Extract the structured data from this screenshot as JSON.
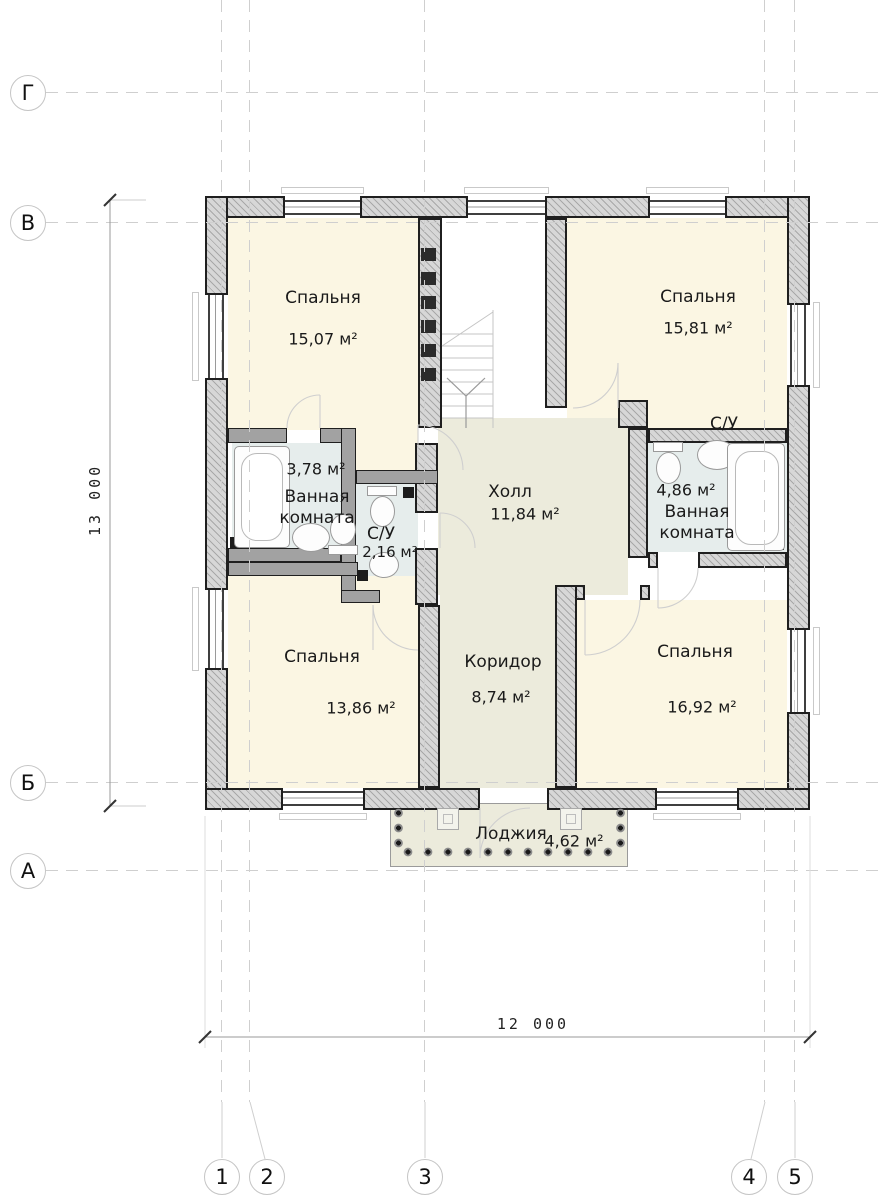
{
  "drawing_type": "architectural floor plan (second storey)",
  "axes": {
    "horizontal": [
      {
        "label": "Г"
      },
      {
        "label": "В"
      },
      {
        "label": "Б"
      },
      {
        "label": "А"
      }
    ],
    "vertical": [
      {
        "label": "1"
      },
      {
        "label": "2"
      },
      {
        "label": "3"
      },
      {
        "label": "4"
      },
      {
        "label": "5"
      }
    ]
  },
  "dims": {
    "height_label": "13 000",
    "width_label": "12 000"
  },
  "rooms": [
    {
      "name": "Спальня",
      "area": "15,07 м²"
    },
    {
      "name": "Спальня",
      "area": "15,81 м²"
    },
    {
      "name": "Ванная комната",
      "area": "3,78 м²"
    },
    {
      "name": "С/У",
      "area": "2,16 м²"
    },
    {
      "name": "Холл",
      "area": "11,84 м²"
    },
    {
      "name": "С/У"
    },
    {
      "name": "Ванная комната",
      "area": "4,86 м²"
    },
    {
      "name": "Спальня",
      "area": "13,86 м²"
    },
    {
      "name": "Коридор",
      "area": "8,74 м²"
    },
    {
      "name": "Спальня",
      "area": "16,92 м²"
    },
    {
      "name": "Лоджия",
      "area": "4,62 м²"
    }
  ],
  "palette": {
    "room_fill": "#fbf6e3",
    "wet_room_fill": "#e6edec",
    "hall_fill": "#ecebdc",
    "wall_fill": "#d7d7d7",
    "wall_outline": "#1f1f1f",
    "grid_line": "#cfcfcf"
  }
}
